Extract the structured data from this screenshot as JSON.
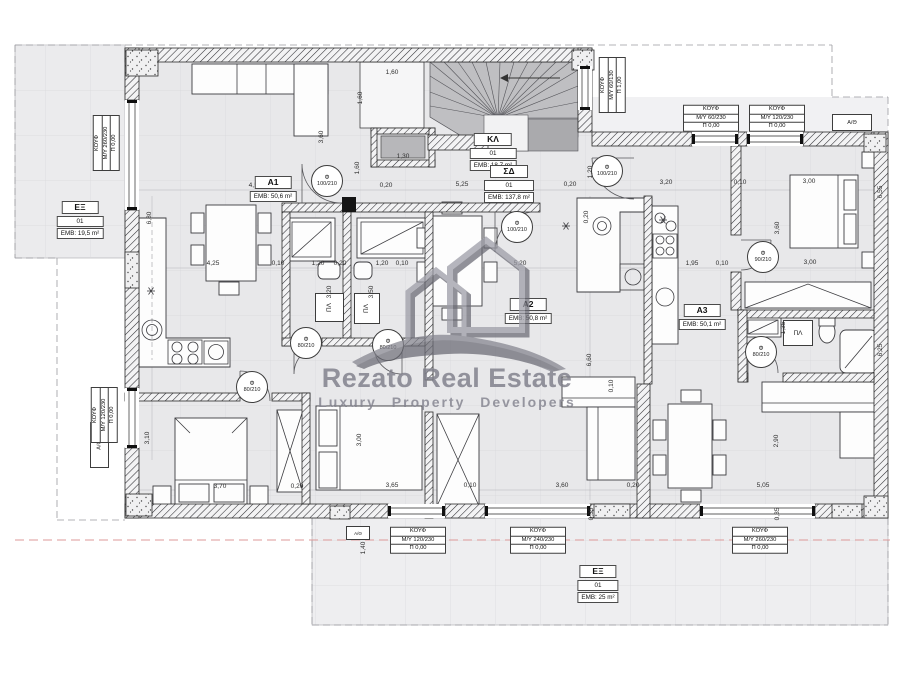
{
  "watermark": {
    "brand": "Rezato Real Estate",
    "tagline": "Luxury Property Developers"
  },
  "rooms": {
    "ex_left": {
      "name": "EΞ",
      "unit": "01",
      "area": "EMB: 19,5 m²"
    },
    "a1": {
      "name": "A1",
      "area": "EMB: 50,6 m²"
    },
    "kl": {
      "name": "ΚΛ",
      "unit": "01",
      "area": "EMB: 18,7 m²"
    },
    "sd": {
      "name": "ΣΔ",
      "unit": "01",
      "area": "EMB: 137,8 m²"
    },
    "a2": {
      "name": "A2",
      "area": "EMB: 50,8 m²"
    },
    "a3": {
      "name": "A3",
      "area": "EMB: 50,1 m²"
    },
    "ex_bottom": {
      "name": "EΞ",
      "unit": "01",
      "area": "EMB: 25 m²"
    }
  },
  "openings": {
    "k1": {
      "title": "ΚΟΥΦ",
      "size": "M/Y 260/230",
      "sill": "Π 0,00"
    },
    "k2": {
      "title": "ΚΟΥΦ",
      "size": "M/Y 120/230",
      "sill": "Π 0,00"
    },
    "k3": {
      "title": "ΚΟΥΦ",
      "size": "M/Y 60/130",
      "sill": "Π 1,00"
    },
    "k4": {
      "title": "ΚΟΥΦ",
      "size": "M/Y 60/230",
      "sill": "Π 0,00"
    },
    "k5": {
      "title": "ΚΟΥΦ",
      "size": "M/Y 120/230",
      "sill": "Π 0,00"
    },
    "k6": {
      "title": "ΚΟΥΦ",
      "size": "M/Y 120/230",
      "sill": "Π 0,00"
    },
    "k7": {
      "title": "ΚΟΥΦ",
      "size": "M/Y 240/230",
      "sill": "Π 0,00"
    },
    "k8": {
      "title": "ΚΟΥΦ",
      "size": "M/Y 260/230",
      "sill": "Π 0,00"
    }
  },
  "doors": {
    "d1": "100/210",
    "d2": "100/210",
    "d3": "100/210",
    "d4": "80/210",
    "d5": "80/210",
    "d6": "80/210",
    "d7": "90/210",
    "d8": "80/210"
  },
  "misc": {
    "phi": "Φ",
    "pl": "ΠΛ",
    "ath": "A/Θ"
  },
  "dims": [
    "1,60",
    "1,60",
    "1,30",
    "3,60",
    "4,55",
    "0,20",
    "5,25",
    "0,20",
    "3,20",
    "0,10",
    "3,00",
    "6,80",
    "4,25",
    "0,10",
    "1,20",
    "0,20",
    "1,20",
    "0,10",
    "5,20",
    "1,95",
    "0,10",
    "3,00",
    "3,60",
    "3,20",
    "3,50",
    "0,20",
    "6,60",
    "3,10",
    "1,35",
    "2,90",
    "3,70",
    "0,20",
    "3,65",
    "0,10",
    "3,60",
    "0,20",
    "5,05",
    "1,40",
    "0,35",
    "0,35",
    "1,60",
    "6,55",
    "6,25",
    "0,10",
    "1,20",
    "3,00"
  ]
}
